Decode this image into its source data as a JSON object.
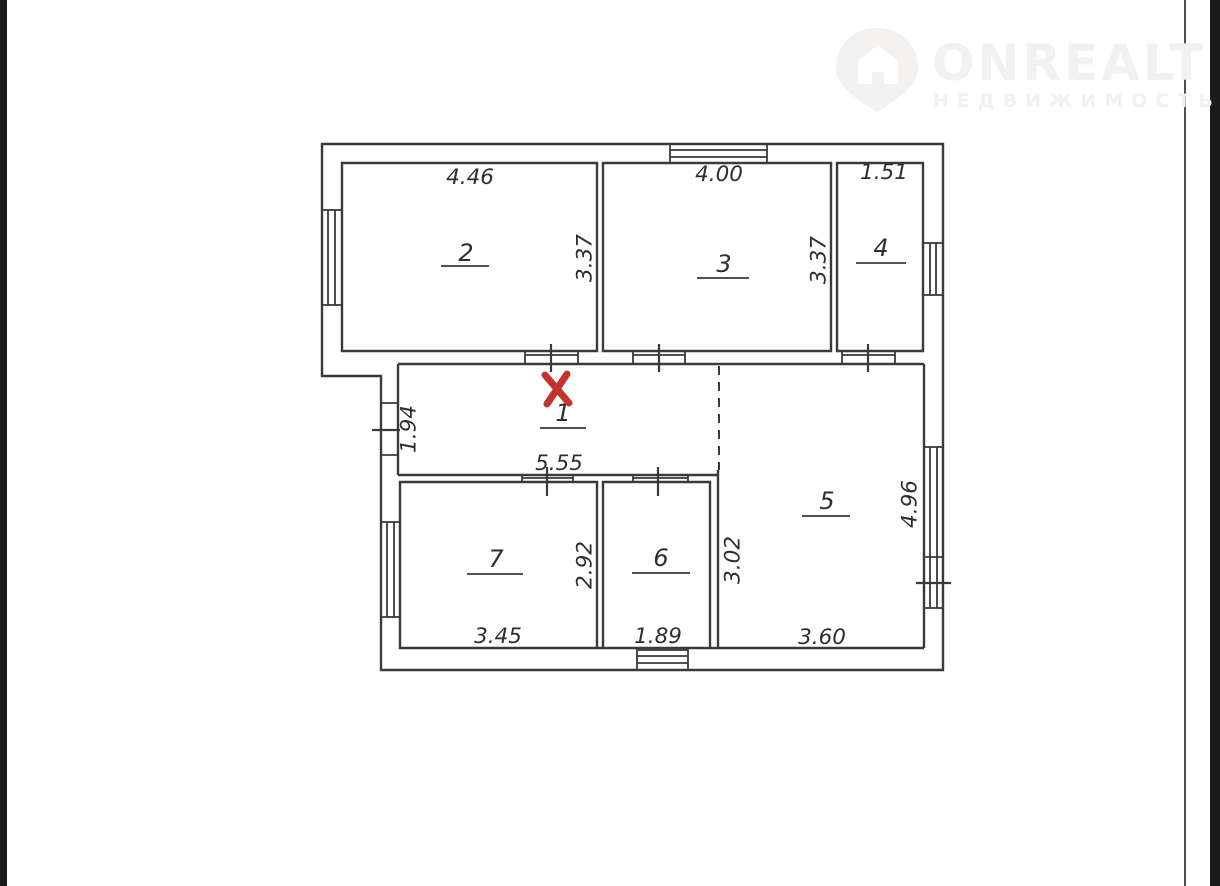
{
  "frame": {
    "left_bar_color": "#1b1b1b",
    "right_bar_color": "#1b1b1b",
    "page_background": "#ffffff",
    "page_edge_line_color": "#4f4f4f"
  },
  "watermark": {
    "brand": "ONREALT",
    "subtitle": "НЕДВИЖИМОСТЬ",
    "icon": "house-location-pin-icon",
    "color": "#f3f1f0"
  },
  "floor_plan": {
    "line_color": "#3a3a3a",
    "text_color": "#2e2e2e",
    "marker": {
      "symbol": "x-cross",
      "color": "#c5342c"
    },
    "symbols": {
      "windows": [
        "top-wall-room-3",
        "left-wall-room-2",
        "right-wall-room-4",
        "left-wall-room-7",
        "right-wall-room-5",
        "bottom-wall-room-6"
      ],
      "doors": [
        "room-2-to-hall",
        "room-3-to-hall",
        "room-4-to-room-5",
        "hall-to-room-7",
        "hall-to-room-6",
        "entrance-left-wall"
      ],
      "dashed_opening": "between-hall-1-and-room-5"
    },
    "rooms": [
      {
        "number": "1",
        "dims": {
          "bottom": "5.55",
          "left": "1.94"
        }
      },
      {
        "number": "2",
        "dims": {
          "top": "4.46",
          "right": "3.37"
        }
      },
      {
        "number": "3",
        "dims": {
          "top": "4.00",
          "right": "3.37"
        }
      },
      {
        "number": "4",
        "dims": {
          "top": "1.51"
        }
      },
      {
        "number": "5",
        "dims": {
          "bottom": "3.60",
          "right": "4.96",
          "left": "3.02"
        }
      },
      {
        "number": "6",
        "dims": {
          "bottom": "1.89"
        }
      },
      {
        "number": "7",
        "dims": {
          "bottom": "3.45",
          "right": "2.92"
        }
      }
    ]
  }
}
